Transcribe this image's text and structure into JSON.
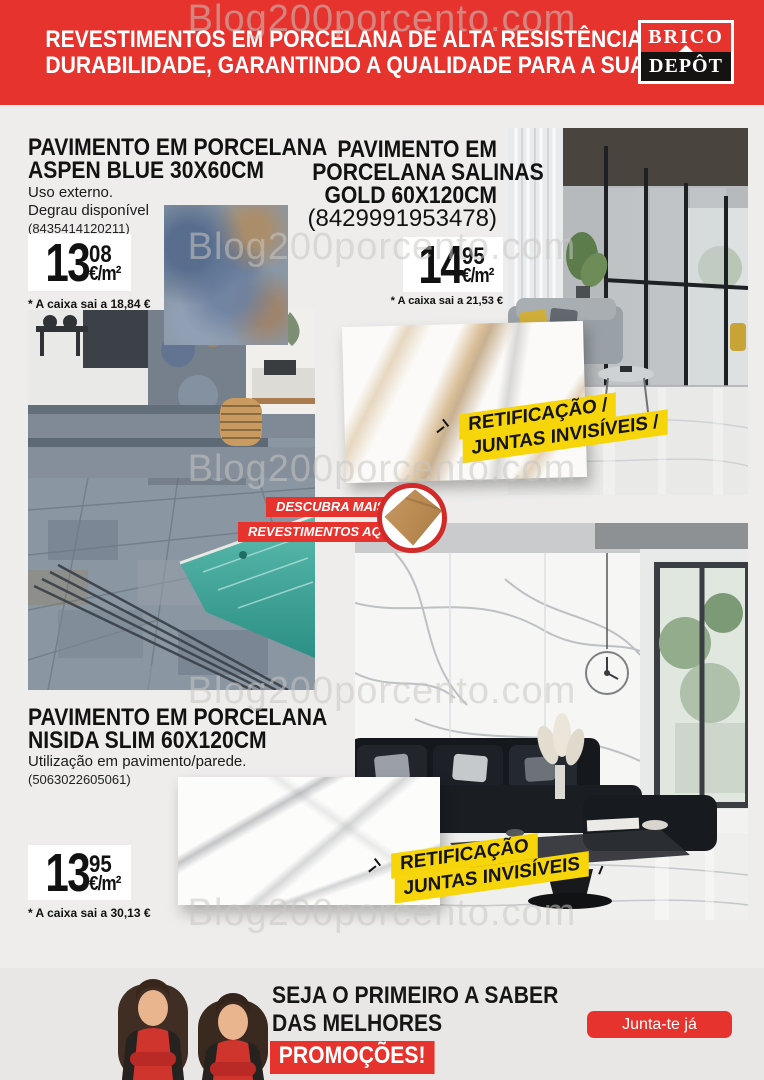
{
  "watermark": "Blog200porcento.com",
  "header": {
    "line1": "REVESTIMENTOS EM PORCELANA DE ALTA RESISTÊNCIA E",
    "line2": "DURABILIDADE, GARANTINDO A QUALIDADE PARA A SUA CASA",
    "logo_top": "BRICO",
    "logo_bottom": "DEPÔT"
  },
  "products": [
    {
      "title_line1": "PAVIMENTO EM PORCELANA",
      "title_line2": "ASPEN BLUE 30X60CM",
      "note1": "Uso externo.",
      "note2": "Degrau disponível",
      "ean": "(8435414120211)",
      "price_int": "13",
      "price_dec": "08",
      "unit": "€/m²",
      "box_note": "* A caixa sai a 18,84 €"
    },
    {
      "title_line1": "PAVIMENTO EM",
      "title_line2": "PORCELANA SALINAS",
      "title_line3": "GOLD 60X120CM",
      "ean": "(8429991953478)",
      "price_int": "14",
      "price_dec": "95",
      "unit": "€/m²",
      "box_note": "* A caixa sai a 21,53 €"
    },
    {
      "title_line1": "PAVIMENTO EM PORCELANA",
      "title_line2": "NISIDA SLIM 60X120CM",
      "note1": "Utilização em pavimento/parede.",
      "ean": "(5063022605061)",
      "price_int": "13",
      "price_dec": "95",
      "unit": "€/m²",
      "box_note": "* A caixa sai a 30,13 €"
    }
  ],
  "badge": {
    "line1": "RETIFICAÇÃO",
    "line2": "JUNTAS INVISÍVEIS",
    "decor_slash": "/"
  },
  "discover": {
    "line1": "DESCUBRA MAIS",
    "line2": "REVESTIMENTOS AQUI"
  },
  "footer": {
    "line1": "SEJA O PRIMEIRO A SABER",
    "line2": "DAS MELHORES",
    "line3": "PROMOÇÕES!",
    "button": "Junta-te já"
  },
  "colors": {
    "red": "#e6332e",
    "yellow": "#f6d50a"
  }
}
